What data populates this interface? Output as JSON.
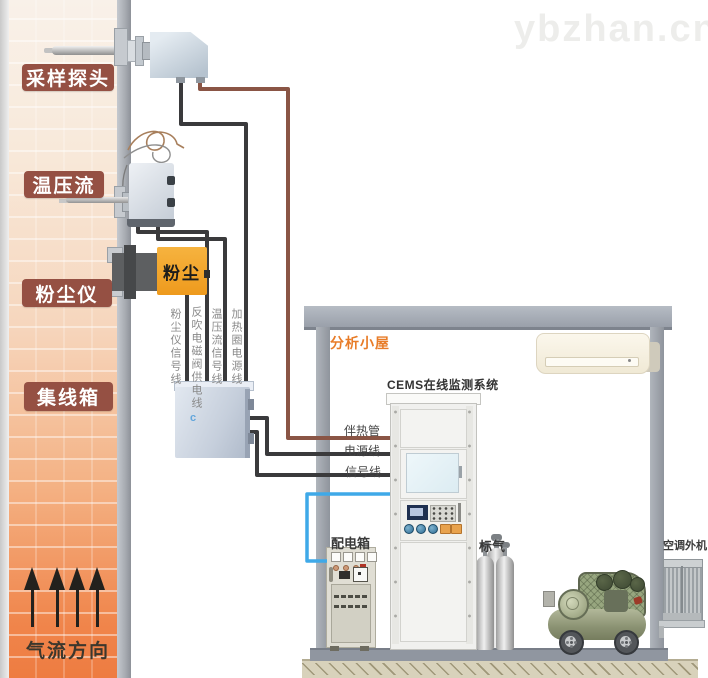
{
  "watermark": "ybzhan.cn",
  "colors": {
    "label_bg": "#955043",
    "accent_orange": "#e87c28",
    "dust_box_orange": "#f2a32c",
    "wire_black": "#3a3a3c",
    "wire_brown": "#8a5545",
    "wire_blue": "#3fa9e8"
  },
  "stack": {
    "labels": {
      "probe": "采样探头",
      "tpf": "温压流",
      "dust": "粉尘仪",
      "junction": "集线箱",
      "airflow": "气流方向"
    },
    "dust_device": "粉尘"
  },
  "junction_box_mark": "c",
  "wiring": {
    "vertical_labels": [
      "粉尘仪信号线",
      "反吹电磁阀供电线",
      "温压流信号线",
      "加热圈电源线"
    ],
    "shelter_labels": [
      "伴热管",
      "电源线",
      "信号线"
    ]
  },
  "shelter": {
    "name": "分析小屋",
    "cems_system": "CEMS在线监测系统",
    "power_box": "配电箱",
    "standard_gas": "标气",
    "ac_outdoor": "空调外机"
  }
}
